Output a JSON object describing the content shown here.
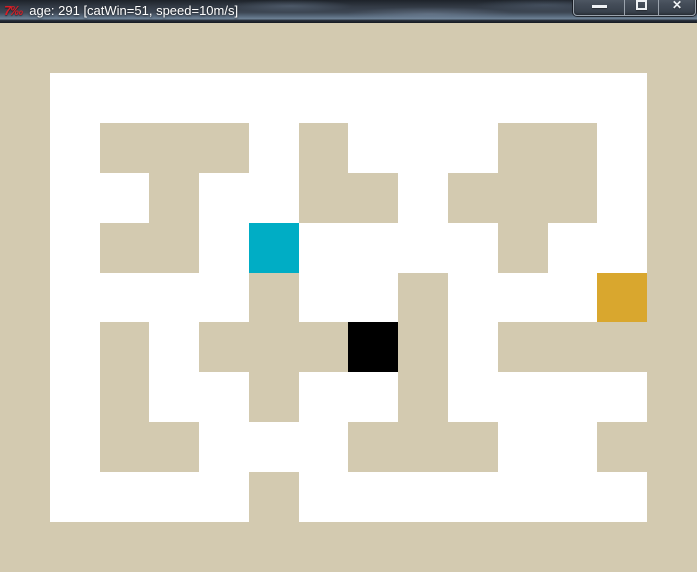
{
  "window": {
    "title": "age: 291 [catWin=51, speed=10m/s]",
    "app_icon_glyph": "7‰",
    "controls": {
      "minimize": "minimize",
      "maximize": "maximize",
      "close_glyph": "✕"
    }
  },
  "hud": {
    "age": 291,
    "cat_win": 51,
    "speed": "10m/s"
  },
  "colors": {
    "wall": "#d3cab0",
    "path": "#ffffff",
    "cyan_agent": "#00adc5",
    "black_agent": "#000000",
    "orange_goal": "#d9a72e",
    "titlebar_text": "#ffffff",
    "app_icon": "#d81f27"
  },
  "maze": {
    "cols": 14,
    "rows": 11,
    "legend": {
      "#": "wall",
      ".": "path",
      "C": "cyan_agent",
      "B": "black_agent",
      "O": "orange_goal"
    },
    "grid": [
      "##############",
      "#............#",
      "#.###.#...##.#",
      "#..#..##.###.#",
      "#.##.C....#..#",
      "#....#..#...O#",
      "#.#.###B#.####",
      "#.#..#..#....#",
      "#.##...###..##",
      "#....#.......#",
      "##############"
    ],
    "entities": {
      "cyan_agent": {
        "row": 4,
        "col": 5
      },
      "black_agent": {
        "row": 6,
        "col": 7
      },
      "orange_goal": {
        "row": 5,
        "col": 12
      }
    }
  }
}
